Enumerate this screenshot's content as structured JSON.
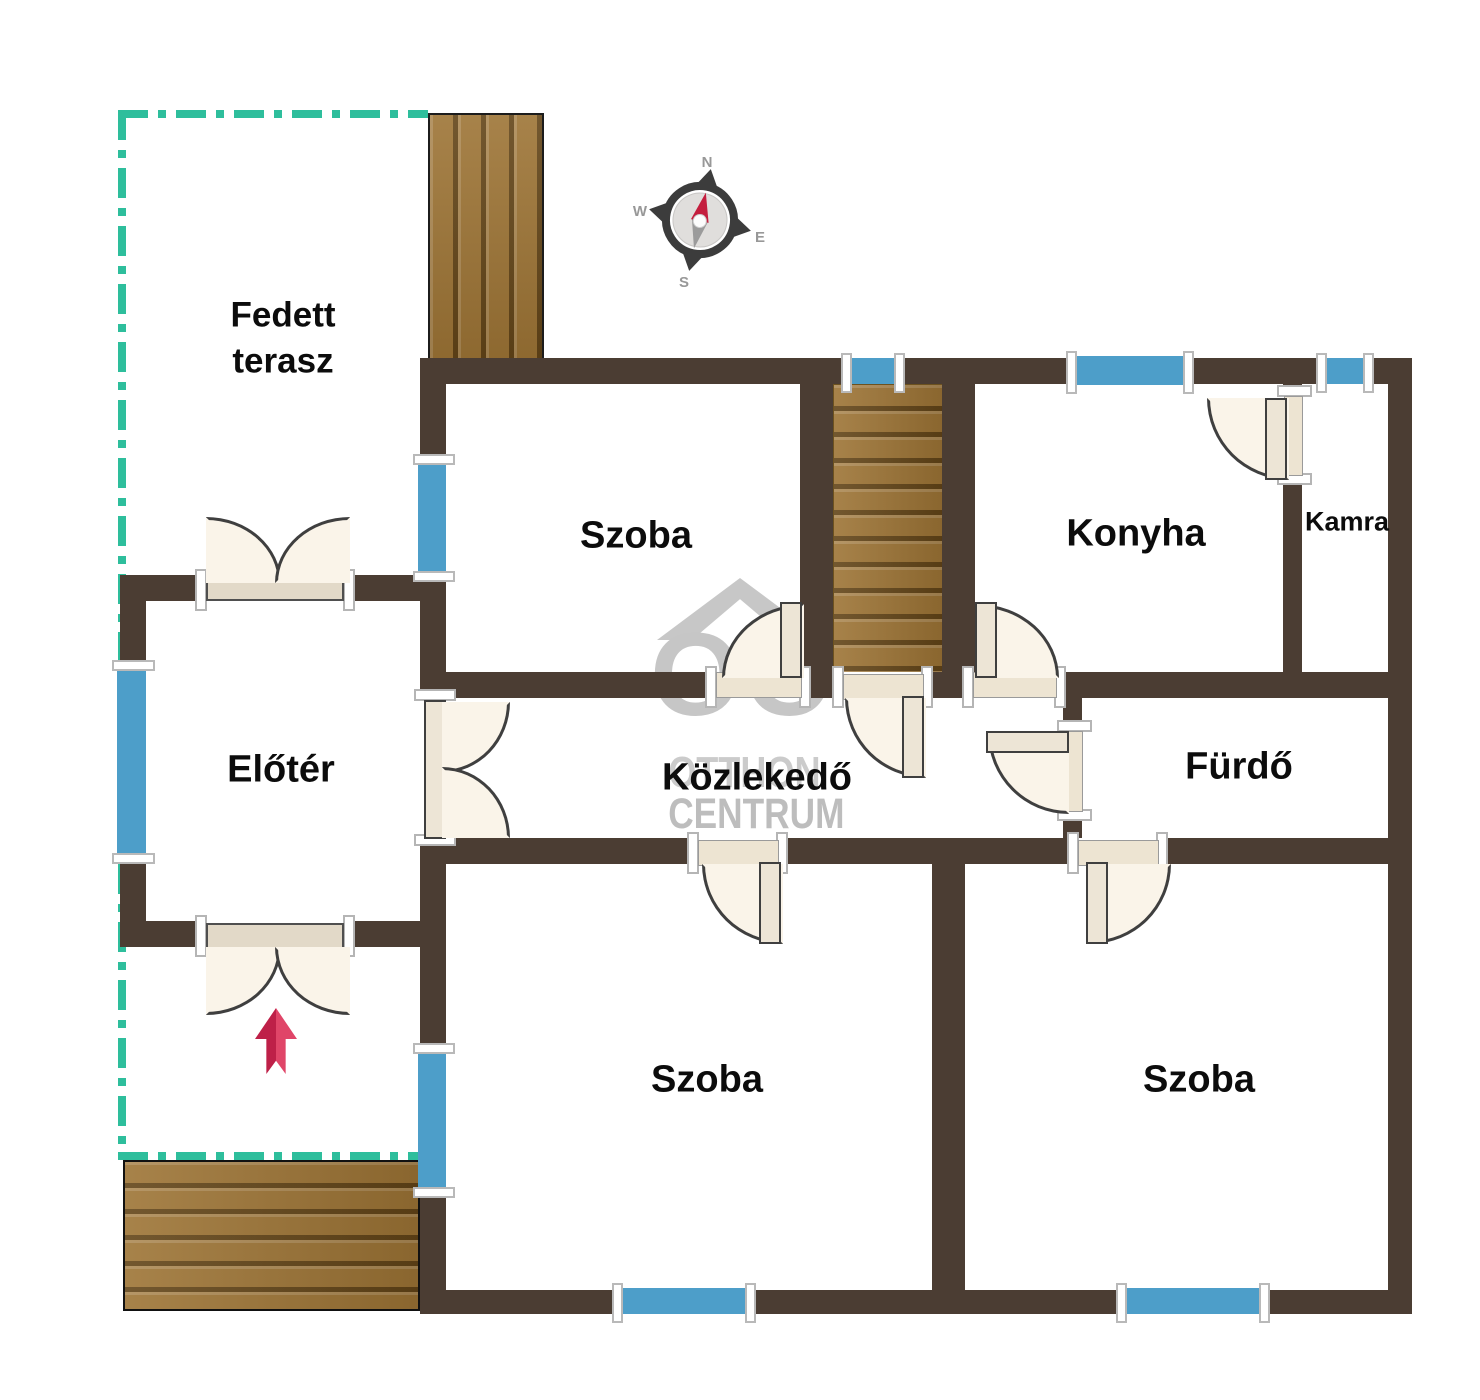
{
  "rooms": {
    "terrace_line1": "Fedett",
    "terrace_line2": "terasz",
    "room_top": "Szoba",
    "kitchen": "Konyha",
    "pantry": "Kamra",
    "foyer": "Előtér",
    "hallway": "Közlekedő",
    "bathroom": "Fürdő",
    "room_bottom_left": "Szoba",
    "room_bottom_right": "Szoba"
  },
  "compass": {
    "north": "N",
    "east": "E",
    "south": "S",
    "west": "W"
  },
  "watermark": {
    "logo": "OC",
    "line1": "OTTHON",
    "line2": "CENTRUM"
  },
  "colors": {
    "wall": "#4B3D33",
    "window": "#4D9EC9",
    "terrace_boundary": "#2EBE9C",
    "wood": "#9D7435",
    "door_leaf": "#FAF4E9",
    "entrance_arrow": "#D02A54",
    "watermark_gray": "#C6C6C6",
    "compass_needle_red": "#C41E3E"
  }
}
